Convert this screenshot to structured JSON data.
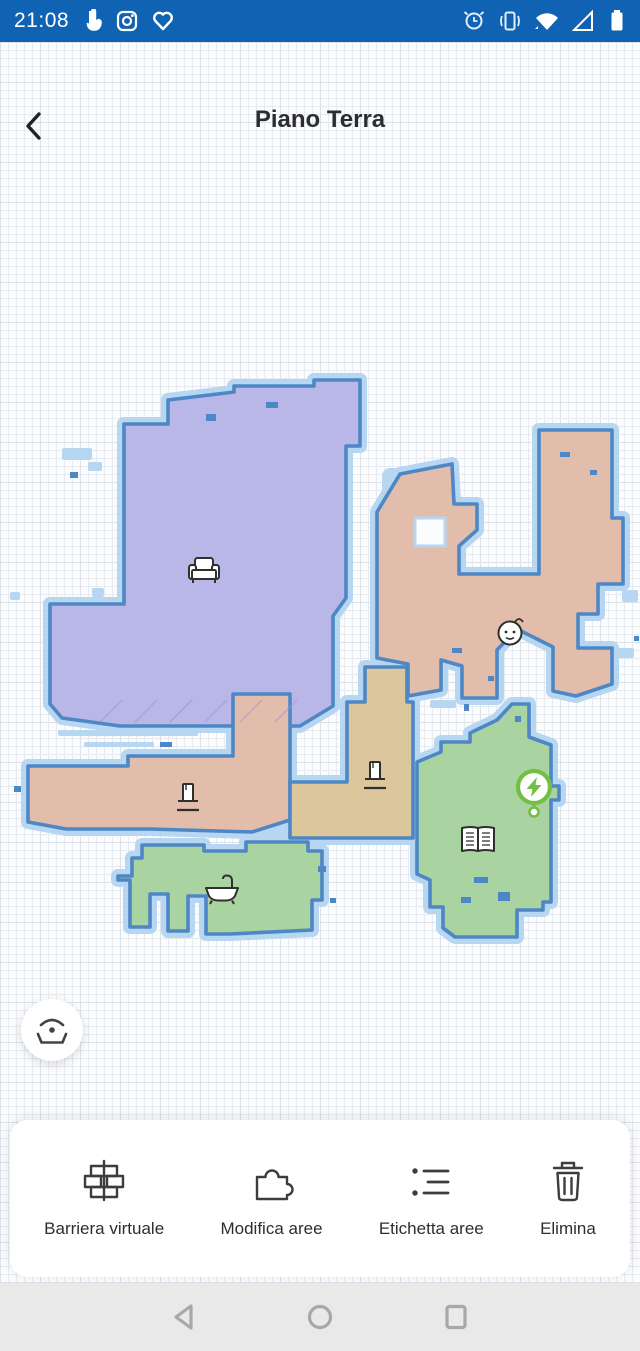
{
  "colors": {
    "status_bar_bg": "#1063b3",
    "title_text": "#2d2d2d",
    "toolbar_label": "#2e2e2e",
    "nav_bar_bg": "#e9e9e9",
    "nav_icon": "#a8a8a8"
  },
  "status_bar": {
    "time": "21:08",
    "left_icons": [
      "touch-icon",
      "instagram-icon",
      "heart-icon"
    ],
    "right_icons": [
      "alarm-icon",
      "vibrate-icon",
      "wifi-icon",
      "signal-icon",
      "battery-icon"
    ]
  },
  "header": {
    "title": "Piano Terra",
    "back_icon": "back-chevron-icon"
  },
  "map": {
    "floor_name": "Piano Terra",
    "colors": {
      "wall": "#4e87c5",
      "halo": "#b7d6f1",
      "background": "#fbfcfd",
      "grid_line": "#e7eaee",
      "grid_major": "#dde2e8"
    },
    "rooms": [
      {
        "id": "living_room",
        "icon": "sofa-icon",
        "color": "#b9b6e8"
      },
      {
        "id": "bedroom",
        "icon": "baby-icon",
        "color": "#e2bdab"
      },
      {
        "id": "corridor",
        "icon": "door-icon",
        "color": "#e2bdab"
      },
      {
        "id": "hallway",
        "icon": "door-icon",
        "color": "#dcc79c"
      },
      {
        "id": "bathroom",
        "icon": "bathtub-icon",
        "color": "#a9d3a1"
      },
      {
        "id": "study",
        "icon": "book-icon",
        "color": "#a9d3a1"
      }
    ],
    "charger": {
      "icon": "charging-dock-icon",
      "color": "#72bf44"
    },
    "locator_button": {
      "icon": "locate-robot-icon"
    }
  },
  "toolbar": {
    "items": [
      {
        "label": "Barriera virtuale",
        "icon": "virtual-barrier-icon"
      },
      {
        "label": "Modifica aree",
        "icon": "edit-areas-icon"
      },
      {
        "label": "Etichetta aree",
        "icon": "label-areas-icon"
      },
      {
        "label": "Elimina",
        "icon": "delete-icon"
      }
    ]
  },
  "nav_bar": {
    "icons": [
      "back-triangle-icon",
      "home-circle-icon",
      "recents-square-icon"
    ]
  }
}
